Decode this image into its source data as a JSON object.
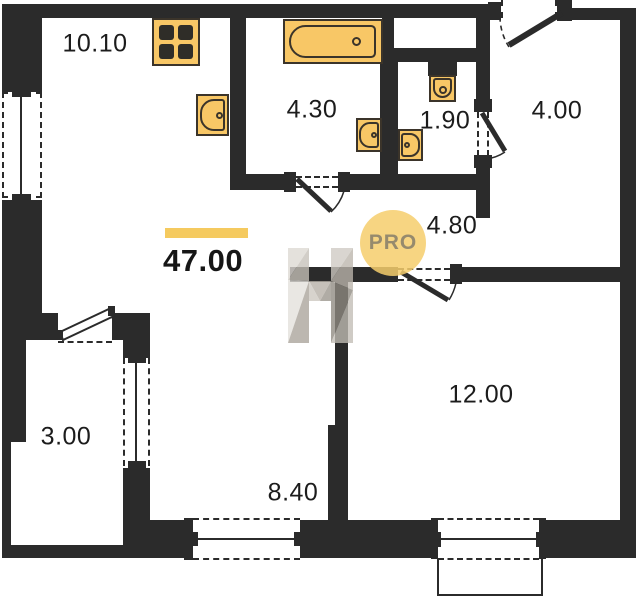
{
  "plan": {
    "total_area_label": "47.00",
    "badge_label": "PRO",
    "rooms": {
      "kitchen_living": "10.10",
      "bathroom": "4.30",
      "wc": "1.90",
      "entry": "4.00",
      "hallway": "4.80",
      "bedroom": "12.00",
      "living": "8.40",
      "balcony": "3.00"
    },
    "colors": {
      "wall": "#2b2b2b",
      "fixture_fill": "#f8c766",
      "fixture_stroke": "#3b342a",
      "accent_bar": "#f5ca5f",
      "badge_fill": "#f6ce6c",
      "badge_text": "#7d7768",
      "watermark_gray": "#b9b4ac"
    },
    "icons": {
      "stove": "stove-icon",
      "bathtub": "bathtub-icon",
      "sink": "sink-icon",
      "toilet": "toilet-icon",
      "watermark": "letter-h-watermark"
    }
  }
}
